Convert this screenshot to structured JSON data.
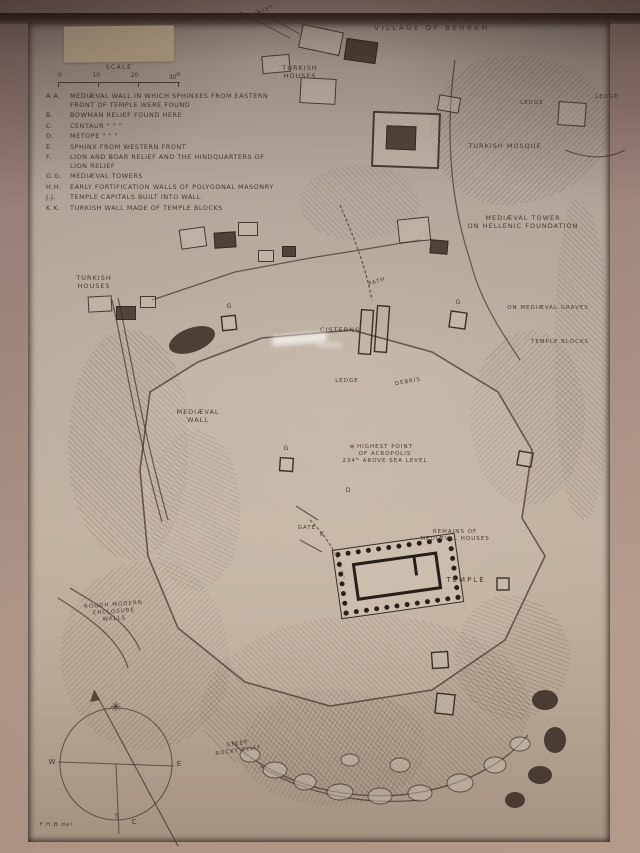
{
  "photo": {
    "description": "Photograph of a framed hand-drawn archaeological site plan",
    "mat_color": "#9c847b",
    "paper_color": "#bcae9f",
    "ink_color": "#4a3a31"
  },
  "title": "VILLAGE OF BEHRÂM",
  "scale": {
    "label": "SCALE",
    "ticks": [
      "0",
      "10",
      "20",
      "30"
    ],
    "unit": "M"
  },
  "legend": {
    "items": [
      {
        "key": "A.A.",
        "text": "MEDIÆVAL WALL IN WHICH SPHINXES FROM EASTERN FRONT OF TEMPLE WERE FOUND"
      },
      {
        "key": "B.",
        "text": "BOWMAN RELIEF FOUND HERE"
      },
      {
        "key": "C.",
        "text": "CENTAUR      \"      \"      \""
      },
      {
        "key": "D.",
        "text": "METOPE      \"      \"      \""
      },
      {
        "key": "E.",
        "text": "SPHINX FROM WESTERN FRONT"
      },
      {
        "key": "F.",
        "text": "LION AND BOAR RELIEF AND THE HINDQUARTERS OF LION RELIEF"
      },
      {
        "key": "G.G.",
        "text": "MEDIÆVAL TOWERS"
      },
      {
        "key": "H.H.",
        "text": "EARLY FORTIFICATION WALLS OF POLYGONAL MASONRY"
      },
      {
        "key": "J.J.",
        "text": "TEMPLE CAPITALS BUILT INTO WALL"
      },
      {
        "key": "K.K.",
        "text": "TURKISH WALL MADE OF TEMPLE BLOCKS"
      }
    ]
  },
  "labels": {
    "street": "STREET",
    "ledge_top_right": "LEDGE",
    "turkish_houses_top": "TURKISH\nHOUSES",
    "ledge_right": "LEDGE",
    "turkish_mosque": "TURKISH MOSQUE",
    "medieval_tower": "MEDIÆVAL TOWER\nON HELLENIC FOUNDATION",
    "turkish_houses_left": "TURKISH\nHOUSES",
    "path": "PATH",
    "cisterns": "CISTERNS",
    "medieval_graves": "ON MEDIÆVAL GRAVES",
    "temple_blocks": "TEMPLE BLOCKS",
    "ledge_center": "LEDGE",
    "debris": "DEBRIS",
    "medieval_wall": "MEDIÆVAL\nWALL",
    "highest_point": "HIGHEST POINT\nOF ACROPOLIS\n234ᴹ ABOVE SEA LEVEL",
    "gate": "GATE",
    "remains_houses": "REMAINS OF\nMEDIÆVAL HOUSES",
    "temple": "TEMPLE",
    "enclosure": "ROUGH MODERN\nENCLOSURE\nWALLS",
    "steep_cliff": "STEEP\nROCKY CLIFF"
  },
  "markers": {
    "g1": "G",
    "g2": "G",
    "g3": "G",
    "d": "D",
    "k": "K",
    "star": "✳"
  },
  "compass": {
    "west": "W",
    "east": "E",
    "south": "S",
    "c": "C",
    "star": "✳"
  },
  "signature": "F.H.B del"
}
